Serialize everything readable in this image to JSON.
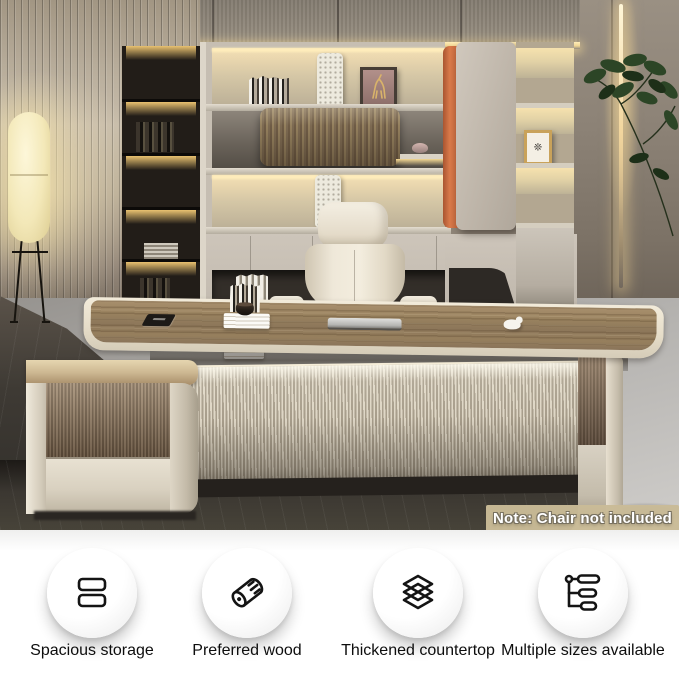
{
  "photo": {
    "description": "Modern executive office with L-shaped walnut and cream desk, backlit shelving wall, floor lamp and plant",
    "note_label": "Note: Chair not included",
    "frame_glyph": "❊"
  },
  "features": {
    "items": [
      {
        "label": "Spacious storage",
        "icon": "drawers-icon"
      },
      {
        "label": "Preferred wood",
        "icon": "wood-log-icon"
      },
      {
        "label": "Thickened countertop",
        "icon": "layers-icon"
      },
      {
        "label": "Multiple sizes available",
        "icon": "size-options-icon"
      }
    ]
  },
  "colors": {
    "accent_orange": "#D97A4A",
    "walnut": "#8D775A",
    "cream_edge": "#E9E2D4",
    "shelf_glow": "#F4E1B6",
    "note_background": "#C9BB97",
    "note_text": "#FFFFFF",
    "floor_dark": "#3E3A34",
    "floor_light": "#B3B1AE",
    "feature_text": "#0D0D0D"
  }
}
